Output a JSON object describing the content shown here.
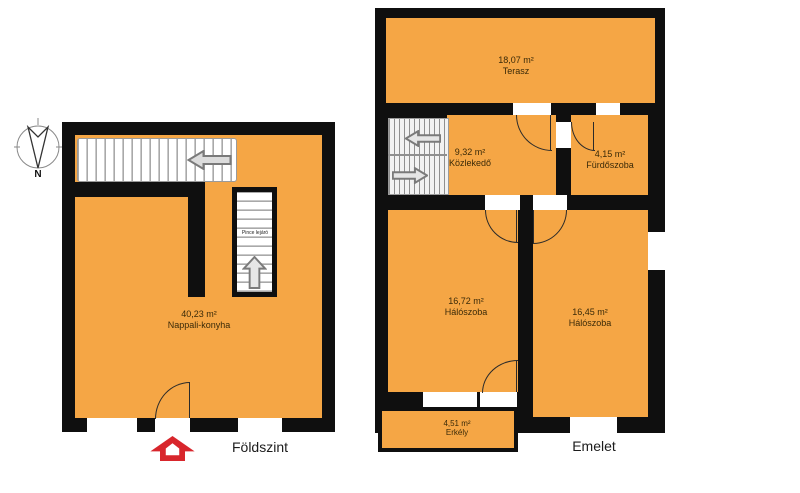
{
  "compass": {
    "north_label": "N"
  },
  "ground_floor": {
    "caption": "Földszint",
    "room": {
      "area": "40,23 m²",
      "name": "Nappali-konyha"
    },
    "stair_label": "Pince lejáró"
  },
  "upper_floor": {
    "caption": "Emelet",
    "rooms": {
      "terasz": {
        "area": "18,07 m²",
        "name": "Terasz"
      },
      "kozlekedo": {
        "area": "9,32 m²",
        "name": "Közlekedő"
      },
      "furdoszoba": {
        "area": "4,15 m²",
        "name": "Fürdőszoba"
      },
      "haloszoba_1": {
        "area": "16,72 m²",
        "name": "Hálószoba"
      },
      "haloszoba_2": {
        "area": "16,45 m²",
        "name": "Hálószoba"
      },
      "erkely": {
        "area": "4,51 m²",
        "name": "Erkély"
      }
    }
  },
  "colors": {
    "floor_fill": "#F5A645",
    "wall": "#0F0F0F",
    "entrance_arrow_red": "#D8262C",
    "stair_arrow_gray": "#7A7A7A"
  }
}
